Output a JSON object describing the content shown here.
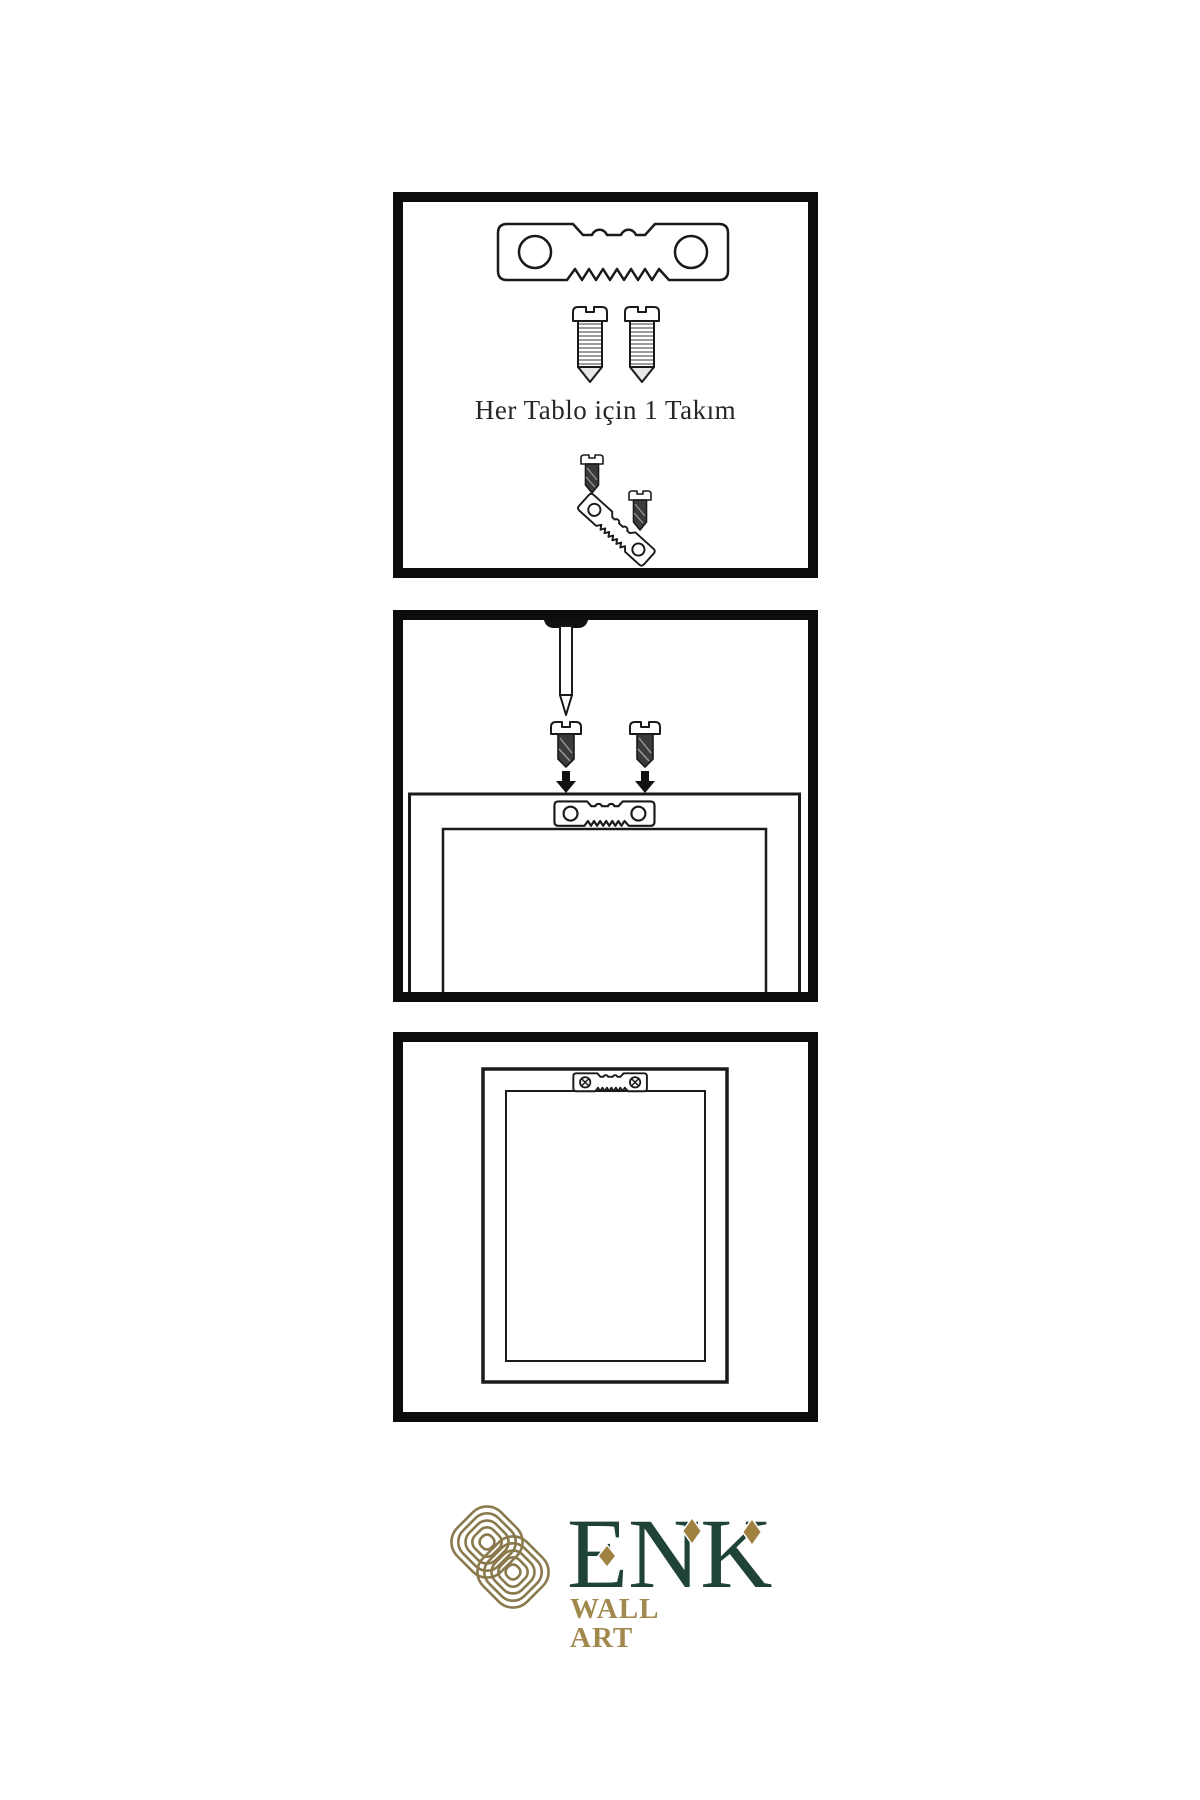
{
  "document": {
    "type": "product-mounting-instructions",
    "background": "#ffffff"
  },
  "panels": [
    {
      "id": "hardware-kit",
      "caption": "Her Tablo için 1 Takım",
      "items": [
        "sawtooth-hanger-plate",
        "mounting-screw",
        "mounting-screw",
        "screw-driven-into-angled-hanger"
      ]
    },
    {
      "id": "mounting-step",
      "items": [
        "wall-nail",
        "dark-screw",
        "dark-screw",
        "down-arrow",
        "down-arrow",
        "frame-back-with-sawtooth-hanger"
      ]
    },
    {
      "id": "hung-frame",
      "items": [
        "frame-back",
        "sawtooth-hanger-with-phillips-screws"
      ]
    }
  ],
  "brand": {
    "name": "ENK",
    "subtitle": "WALL ART"
  },
  "colors": {
    "panel_border": "#0d0d0d",
    "diagram_line": "#1a1a1a",
    "dark_screw_fill": "#3b3b3b",
    "brand_green": "#1f4339",
    "brand_gold": "#a1894e",
    "knot_gold": "#8a794c",
    "diamond_gold": "#a0813f"
  }
}
